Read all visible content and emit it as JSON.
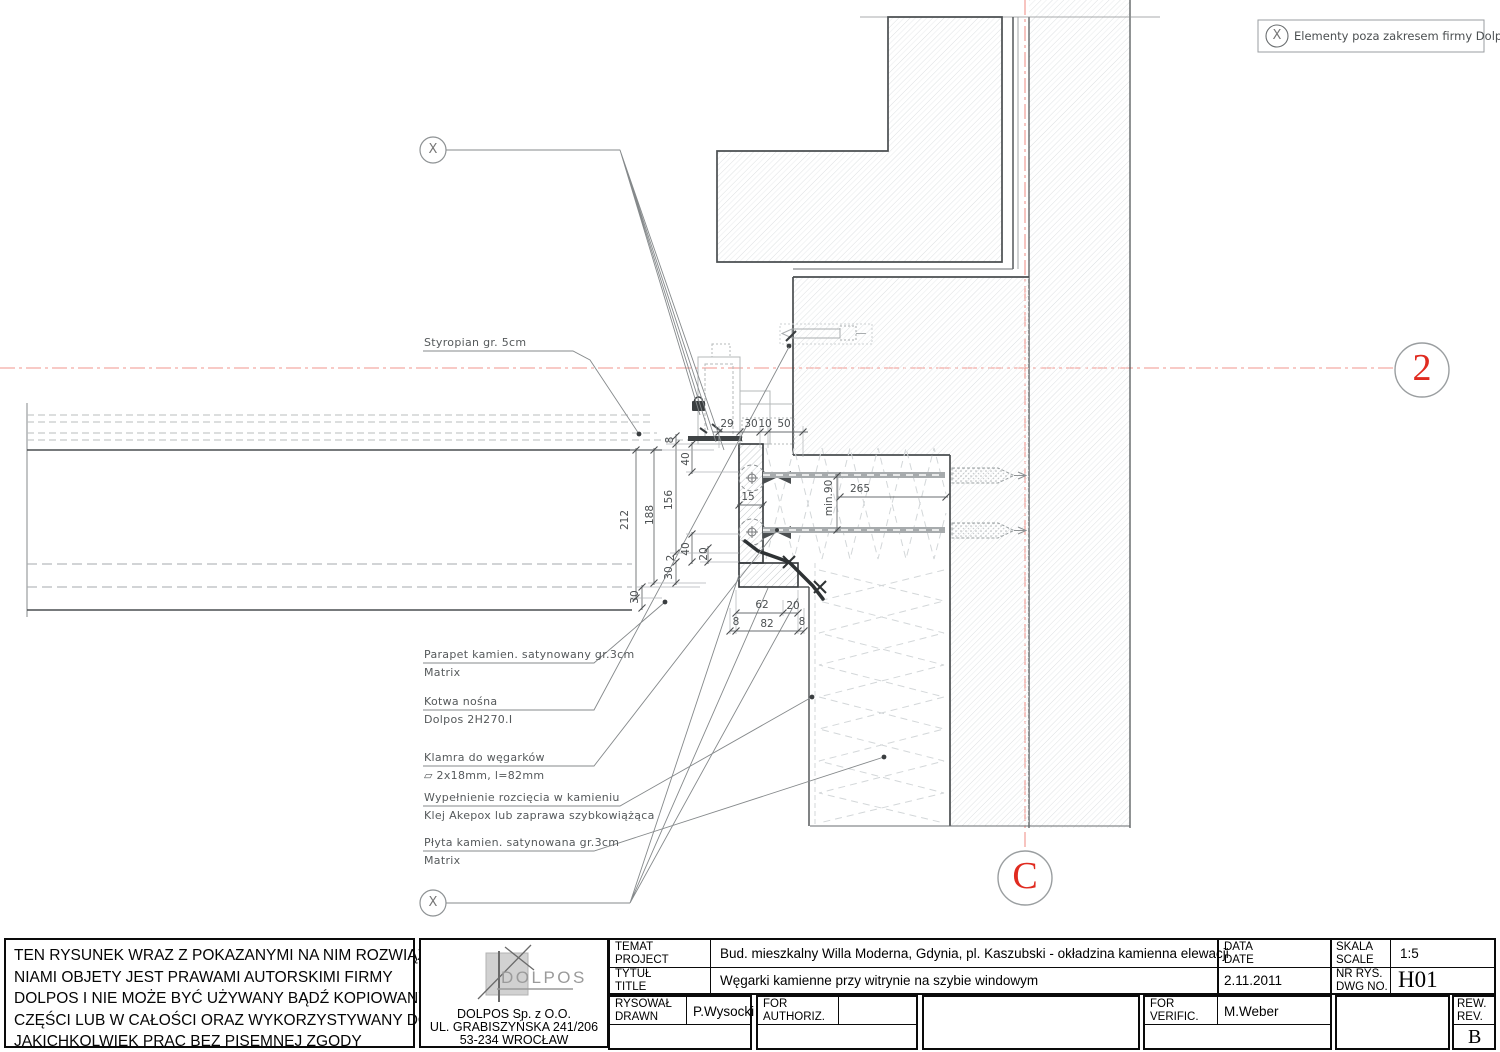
{
  "legend": {
    "symbol": "X",
    "text": "Elementy poza zakresem firmy Dolpos"
  },
  "axis_markers": {
    "right": "2",
    "bottom": "C",
    "scope_top": "X",
    "scope_bottom": "X"
  },
  "callouts": [
    {
      "x": 424,
      "y": 351,
      "title": "Styropian gr. 5cm",
      "sub": ""
    },
    {
      "x": 424,
      "y": 663,
      "title": "Parapet kamien. satynowany gr.3cm",
      "sub": "Matrix"
    },
    {
      "x": 424,
      "y": 710,
      "title": "Kotwa nośna",
      "sub": "Dolpos 2H270.I"
    },
    {
      "x": 424,
      "y": 766,
      "title": "Klamra do węgarków",
      "sub": "▱ 2x18mm, l=82mm"
    },
    {
      "x": 424,
      "y": 806,
      "title": "Wypełnienie rozcięcia w kamieniu",
      "sub": "Klej Akepox lub zaprawa szybkowiążąca"
    },
    {
      "x": 424,
      "y": 851,
      "title": "Płyta kamien. satynowana gr.3cm",
      "sub": "Matrix"
    }
  ],
  "dimensions": [
    {
      "t": "29",
      "x": 727,
      "y": 424
    },
    {
      "t": "30",
      "x": 751,
      "y": 424
    },
    {
      "t": "10",
      "x": 765,
      "y": 424
    },
    {
      "t": "50",
      "x": 784,
      "y": 424
    },
    {
      "t": "8",
      "x": 670,
      "y": 440,
      "r": 1
    },
    {
      "t": "40",
      "x": 686,
      "y": 459,
      "r": 1
    },
    {
      "t": "156",
      "x": 669,
      "y": 500,
      "r": 1
    },
    {
      "t": "188",
      "x": 650,
      "y": 515,
      "r": 1
    },
    {
      "t": "212",
      "x": 625,
      "y": 520,
      "r": 1
    },
    {
      "t": "15",
      "x": 748,
      "y": 497
    },
    {
      "t": "min.90",
      "x": 829,
      "y": 498,
      "r": 1
    },
    {
      "t": "265",
      "x": 860,
      "y": 489
    },
    {
      "t": "40",
      "x": 686,
      "y": 549,
      "r": 1
    },
    {
      "t": "20",
      "x": 704,
      "y": 554,
      "r": 1
    },
    {
      "t": "2",
      "x": 671,
      "y": 558,
      "r": 1
    },
    {
      "t": "30",
      "x": 669,
      "y": 573,
      "r": 1
    },
    {
      "t": "30",
      "x": 635,
      "y": 597,
      "r": 1
    },
    {
      "t": "62",
      "x": 762,
      "y": 605
    },
    {
      "t": "20",
      "x": 793,
      "y": 606
    },
    {
      "t": "8",
      "x": 736,
      "y": 622
    },
    {
      "t": "82",
      "x": 767,
      "y": 624
    },
    {
      "t": "8",
      "x": 802,
      "y": 622
    }
  ],
  "copyright": {
    "lines": [
      "TEN RYSUNEK WRAZ Z POKAZANYMI NA NIM ROZWIĄZA-",
      "NIAMI OBJETY JEST PRAWAMI AUTORSKIMI FIRMY",
      "DOLPOS I NIE MOŻE BYĆ UŻYWANY BĄDŹ KOPIOWANY W",
      "CZĘŚCI LUB W CAŁOŚCI ORAZ WYKORZYSTYWANY DO",
      "JAKICHKOLWIEK PRAC BEZ PISEMNEJ ZGODY"
    ]
  },
  "company": {
    "logo_text": "DOLPOS",
    "name": "DOLPOS Sp. z O.O.",
    "street": "UL. GRABISZYŃSKA 241/206",
    "city": "53-234 WROCŁAW"
  },
  "titleblock": {
    "temat_l1": "TEMAT",
    "temat_l2": "PROJECT",
    "project_value": "Bud. mieszkalny Willa Moderna, Gdynia, pl. Kaszubski - okładzina kamienna elewacji",
    "tytul_l1": "TYTUŁ",
    "tytul_l2": "TITLE",
    "title_value": "Węgarki kamienne przy witrynie na szybie windowym",
    "data_l1": "DATA",
    "data_l2": "DATE",
    "date_value": "2.11.2011",
    "skala_l1": "SKALA",
    "skala_l2": "SCALE",
    "scale_value": "1:5",
    "nr_l1": "NR RYS.",
    "nr_l2": "DWG NO.",
    "dwg_no": "H01",
    "rysowal_l1": "RYSOWAŁ",
    "rysowal_l2": "DRAWN",
    "drawn_by": "P.Wysocki",
    "authoriz_l1": "FOR",
    "authoriz_l2": "AUTHORIZ.",
    "verific_l1": "FOR",
    "verific_l2": "VERIFIC.",
    "verified_by": "M.Weber",
    "rew_l1": "REW.",
    "rew_l2": "REV.",
    "revision": "B"
  },
  "colors": {
    "axis_red": "#f0948d",
    "marker_red": "#e02b20",
    "line_dark": "#454545",
    "line_light": "#b4b8ba",
    "hatch": "#d9dcde"
  }
}
